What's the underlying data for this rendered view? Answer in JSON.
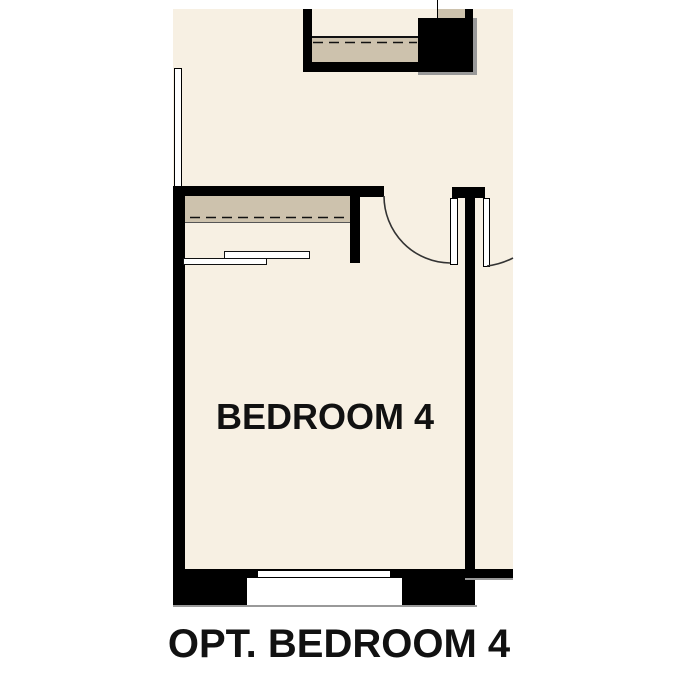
{
  "labels": {
    "room": "BEDROOM 4",
    "caption": "OPT. BEDROOM 4"
  },
  "colors": {
    "floor": "#f7f0e3",
    "shelf": "#cdc2ad",
    "wall": "#000000",
    "shadow": "#999999",
    "line": "#333333",
    "edge": "#555555",
    "text": "#111111",
    "page": "#ffffff"
  }
}
